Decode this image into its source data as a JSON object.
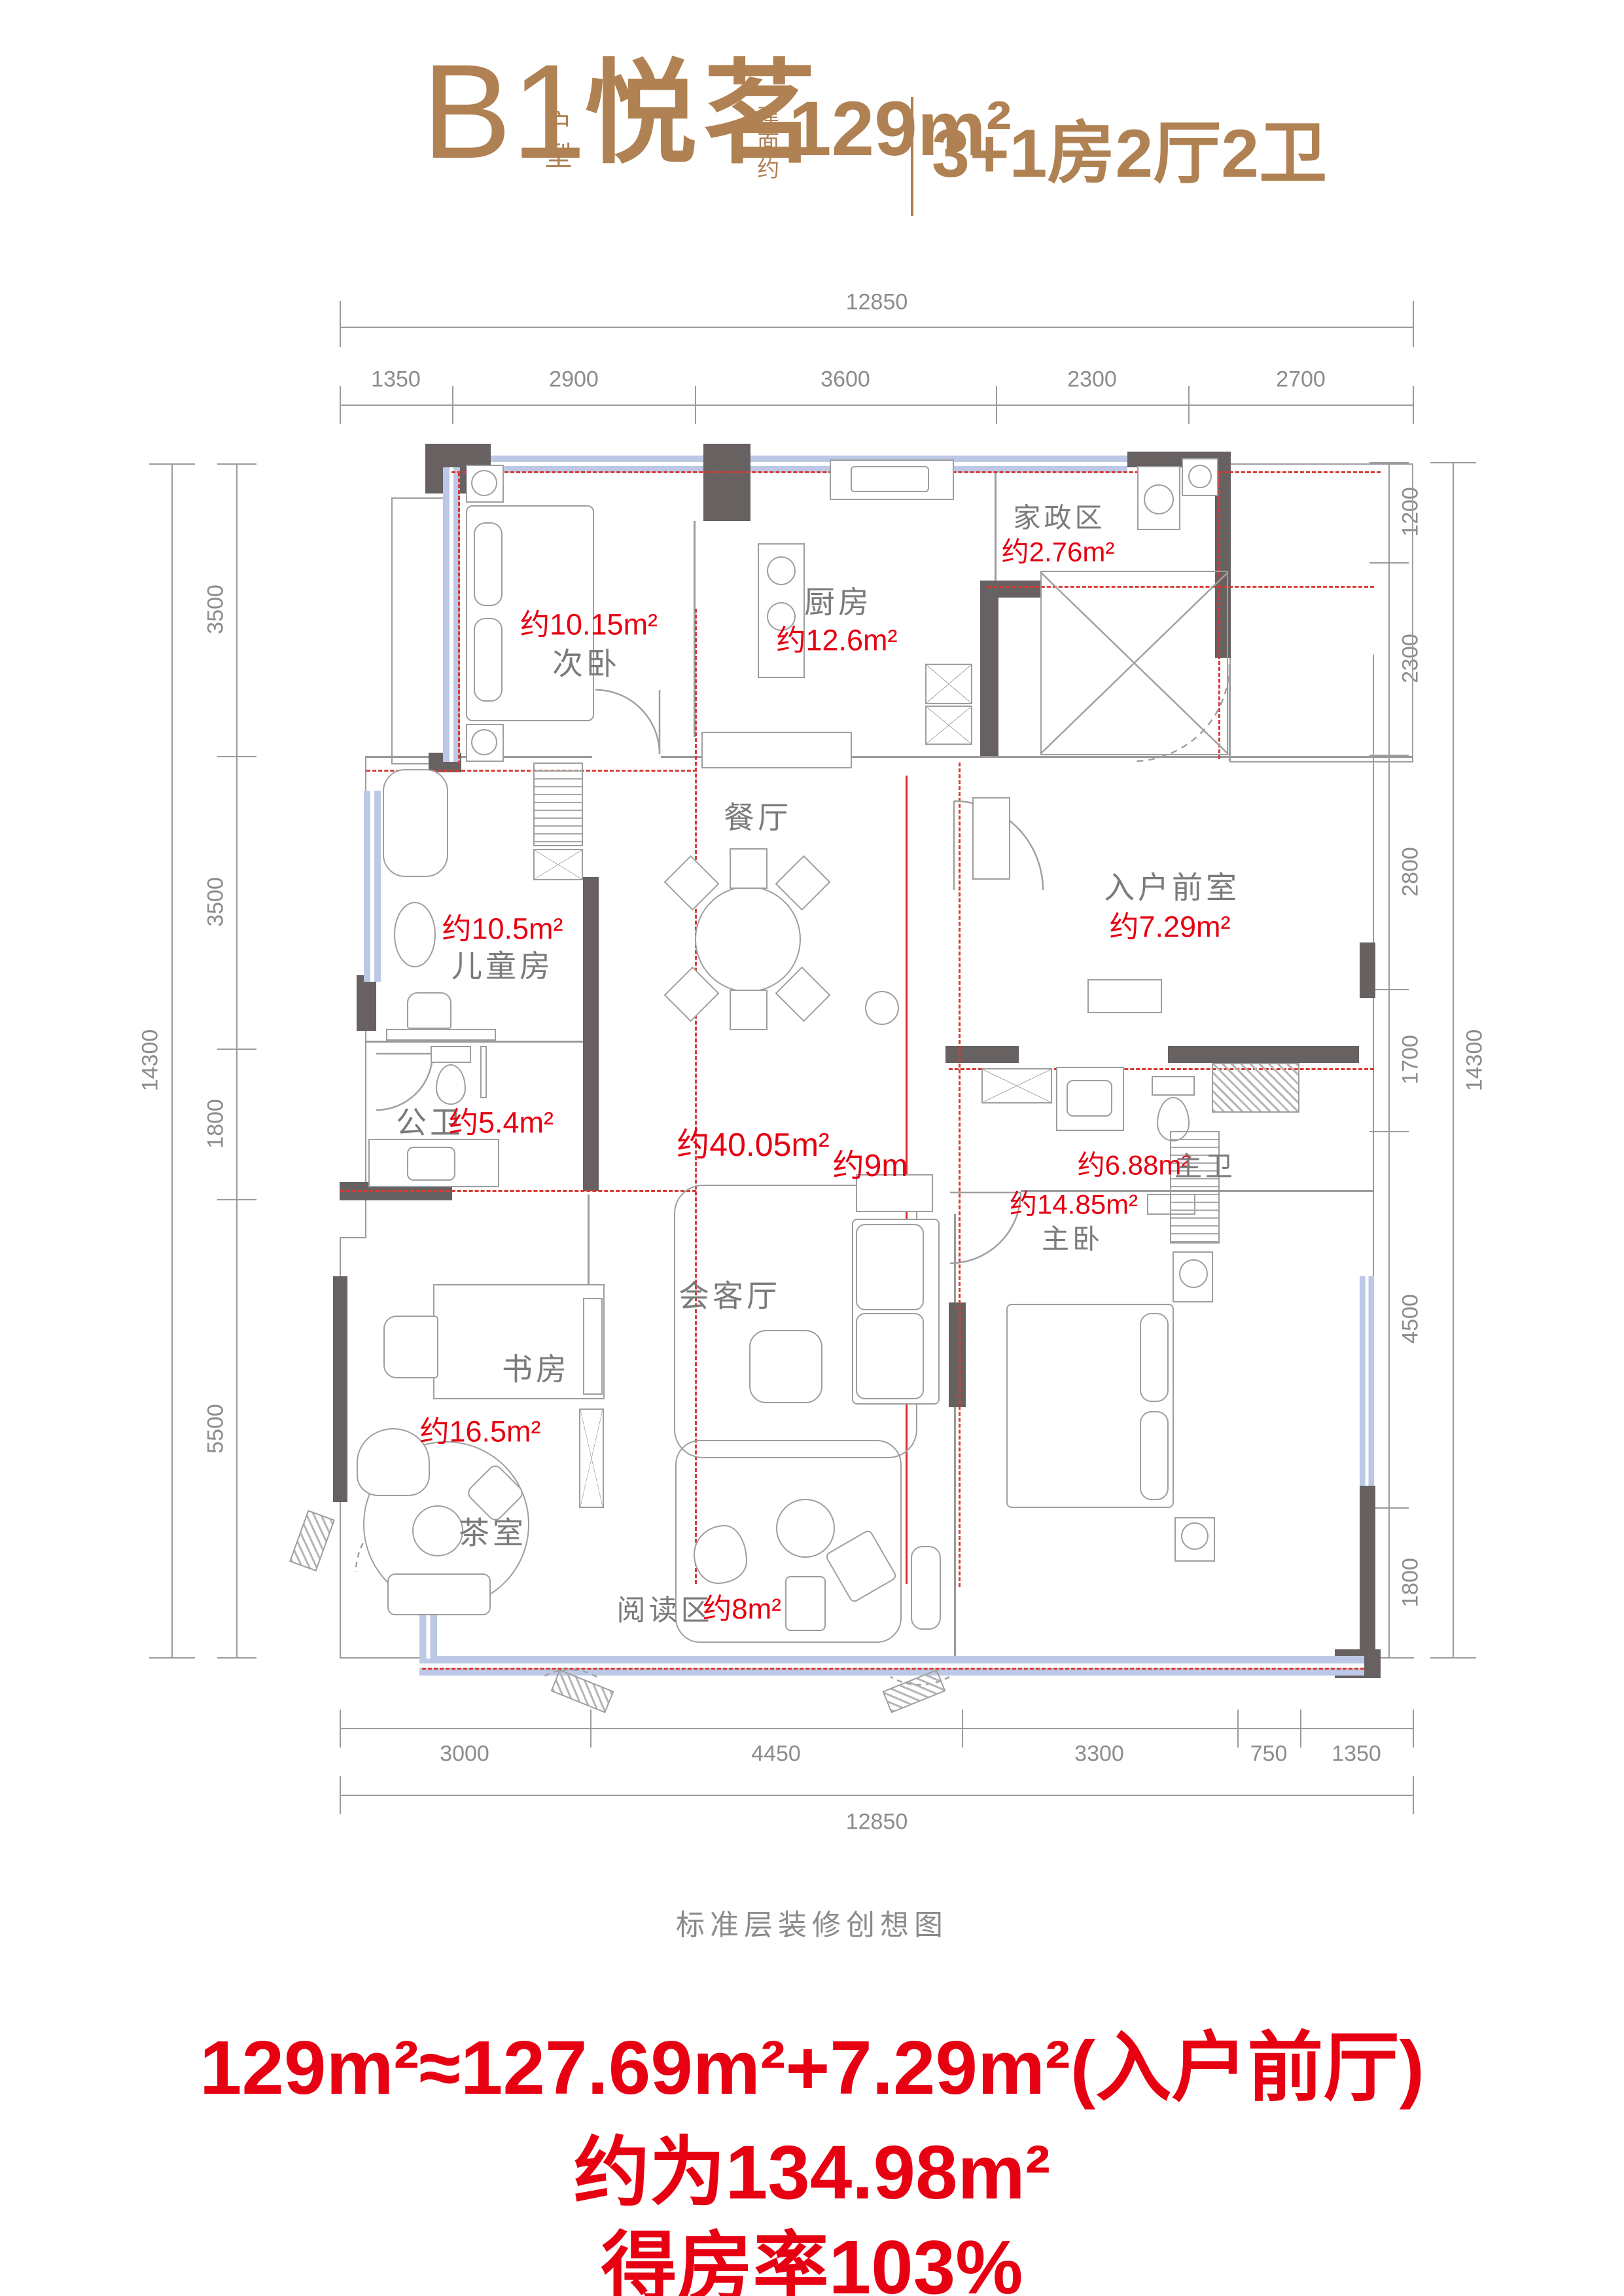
{
  "header": {
    "code": "B1",
    "code_suffix": "户型",
    "name": "悦茗",
    "area_label": "建面约",
    "area": "129m²",
    "layout": "3+1房2厅2卫"
  },
  "dims": {
    "top_total": "12850",
    "top": [
      "1350",
      "2900",
      "3600",
      "2300",
      "2700"
    ],
    "bottom": [
      "3000",
      "4450",
      "3300",
      "750",
      "1350"
    ],
    "bottom_total": "12850",
    "left_total": "14300",
    "left": [
      "3500",
      "3500",
      "1800",
      "5500"
    ],
    "right": [
      "1200",
      "2300",
      "2800",
      "1700",
      "4500",
      "1800"
    ],
    "right_total": "14300"
  },
  "rooms": {
    "ciwo": {
      "area": "约10.15m²",
      "name": "次卧"
    },
    "chufang": {
      "name": "厨房",
      "area": "约12.6m²"
    },
    "jiazhengqu": {
      "name": "家政区",
      "area": "约2.76m²"
    },
    "ertongfang": {
      "area": "约10.5m²",
      "name": "儿童房"
    },
    "canting": {
      "name": "餐厅"
    },
    "ruhuqianshi": {
      "name": "入户前室",
      "area": "约7.29m²"
    },
    "gongwei": {
      "name": "公卫",
      "area": "约5.4m²"
    },
    "zhuwei": {
      "area": "约6.88m²",
      "name": "主卫"
    },
    "huiketing": {
      "area": "约40.05m²",
      "span": "约9m",
      "name": "会客厅"
    },
    "zhuwo": {
      "area": "约14.85m²",
      "name": "主卧"
    },
    "shufang": {
      "name": "书房",
      "area": "约16.5m²"
    },
    "chashi": {
      "name": "茶室"
    },
    "yueduqu": {
      "name": "阅读区",
      "area": "约8m²"
    }
  },
  "footer": {
    "caption": "标准层装修创想图",
    "formula": "129m²≈127.69m²+7.29m²(入户前厅)",
    "approx": "约为134.98m²",
    "rate": "得房率103%"
  },
  "colors": {
    "brand_brown": "#b08152",
    "accent_red": "#e60012",
    "dash_red": "#d93a32",
    "text_gray": "#7b7b7b",
    "dim_gray": "#8c8c8c",
    "wall_dark": "#676161",
    "window_blue": "#bcc8e6"
  }
}
